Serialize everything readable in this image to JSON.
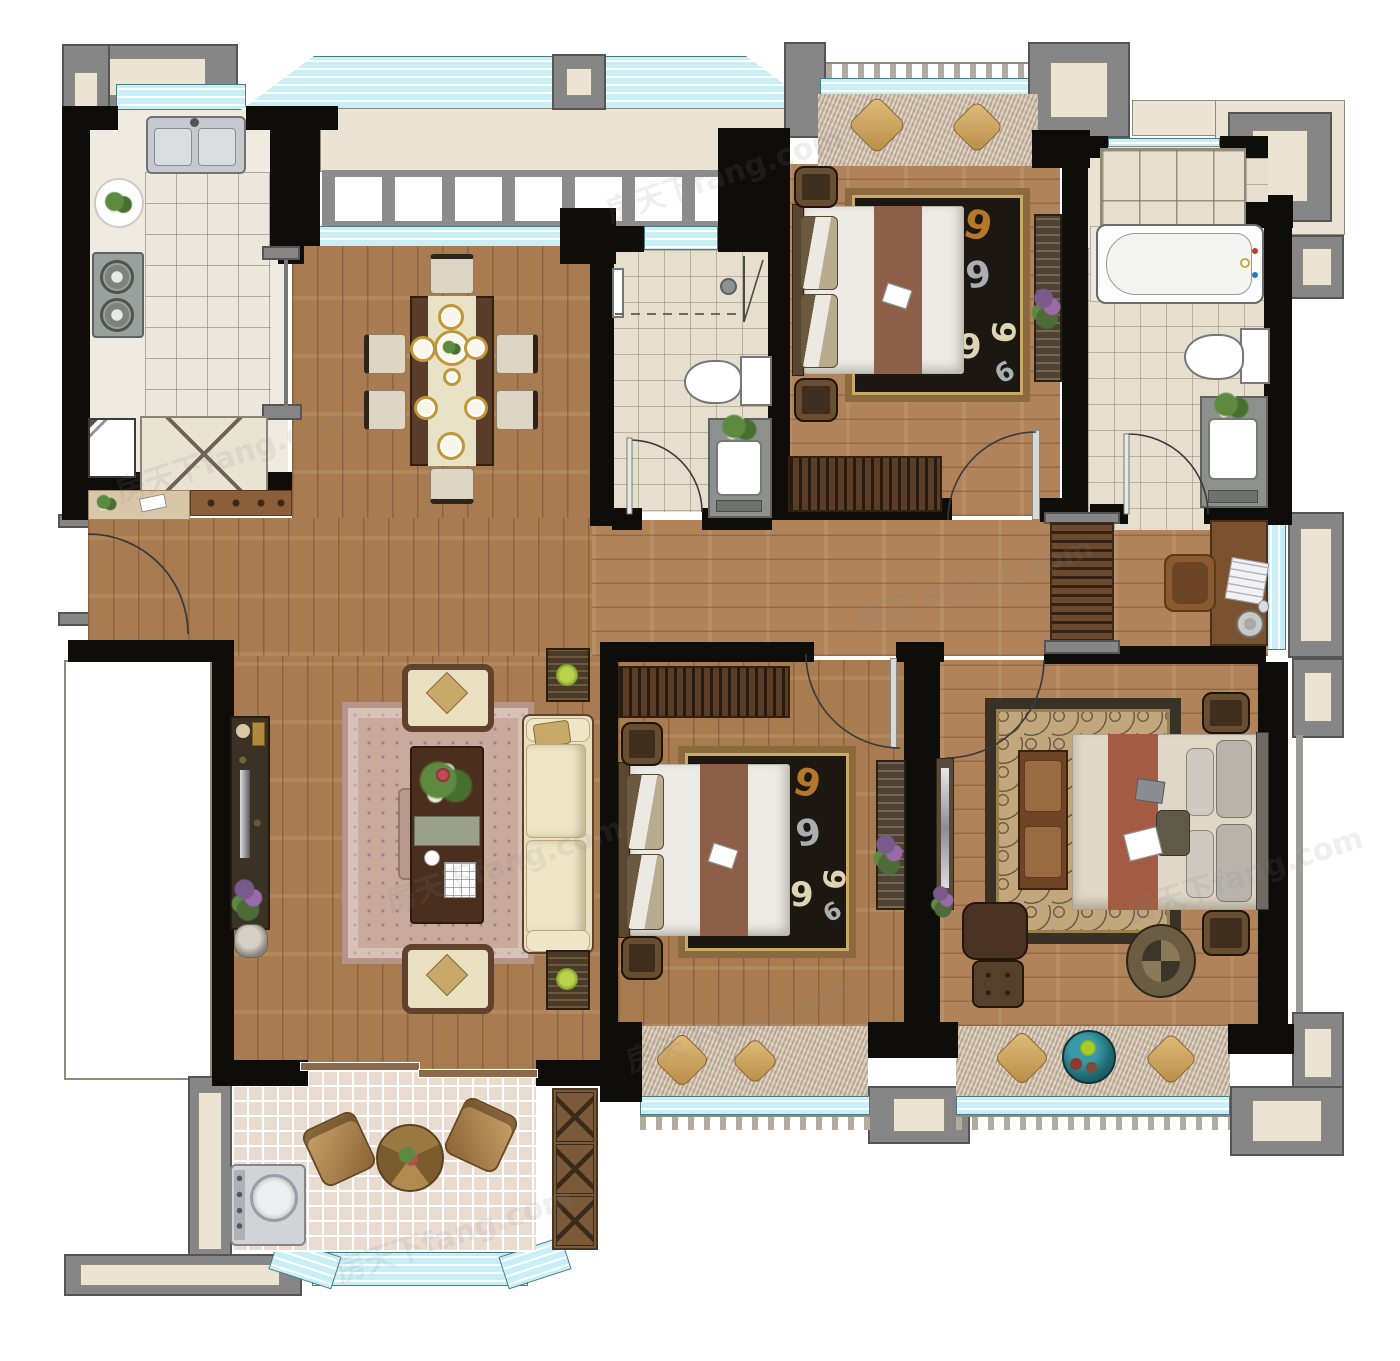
{
  "watermark": {
    "text": "房天下fang.com"
  },
  "colors": {
    "wall": "#0f0d0a",
    "wood": "#a87c50",
    "woodLight": "#b0835a",
    "glass": "#c7eff5",
    "glassEdge": "#4a7d86",
    "trimGray": "#868686",
    "trimDark": "#555555",
    "beige": "#ebe4d2",
    "beigeLine": "#8f8a79",
    "tileKitchen": "#ece7dd",
    "tileBath": "#e6dfcd",
    "tileBalcony": "#eadbd0",
    "shag": "#c9b7a1",
    "rugBlack": "#1d1712",
    "rugGold": "#b5782a",
    "rugSilver": "#a9aeb3",
    "rugCream": "#ddd3b5",
    "rugTrim": "#8a6a3e",
    "masterRug": "#c2a77d",
    "masterRugDark": "#3a3126",
    "livingRug": "#c9ab9d",
    "livingRugTrim": "#b5948a",
    "sofa": "#e9e0c2",
    "frame": "#5f412c",
    "bedWhite": "#edebe6",
    "runner": "#8d5f49",
    "masterRunner": "#a35c43",
    "steel": "#c6c9ce",
    "counter": "#f0ebe1"
  },
  "rooms": [
    {
      "name": "kitchen",
      "furniture": [
        "double-sink",
        "gas-stove",
        "prep-plate",
        "refrigerator",
        "base-cabinet",
        "pocket-door"
      ]
    },
    {
      "name": "dining-room",
      "furniture": [
        "dining-table",
        "table-runner",
        "six-chairs",
        "gold-rim-tableware"
      ]
    },
    {
      "name": "foyer",
      "furniture": [
        "entry-door",
        "shoe-console"
      ]
    },
    {
      "name": "interior-bathroom",
      "furniture": [
        "shower-area",
        "shower-glass",
        "toilet",
        "vanity-with-plant",
        "door"
      ]
    },
    {
      "name": "bedroom-top-right",
      "furniture": [
        "double-bed",
        "two-nightstands",
        "black-swirl-rug",
        "slatted-wardrobe",
        "tall-cabinet",
        "door"
      ]
    },
    {
      "name": "walk-in-closet",
      "furniture": [
        "wardrobe-cabinets"
      ]
    },
    {
      "name": "master-bathroom",
      "furniture": [
        "bathtub",
        "toilet",
        "vanity-with-plant",
        "door"
      ]
    },
    {
      "name": "hallway-study",
      "furniture": [
        "slatted-cabinet",
        "desk",
        "desk-chair",
        "laptop",
        "mug"
      ]
    },
    {
      "name": "living-room",
      "furniture": [
        "three-seat-sofa",
        "two-armchairs",
        "coffee-table",
        "tv-console",
        "two-side-tables",
        "purple-plant",
        "ornate-rug",
        "sliding-door"
      ]
    },
    {
      "name": "bedroom-bottom-middle",
      "furniture": [
        "double-bed",
        "two-nightstands",
        "black-swirl-rug",
        "slatted-wardrobe",
        "tall-cabinet",
        "door"
      ]
    },
    {
      "name": "master-bedroom",
      "furniture": [
        "double-bed",
        "foot-bench",
        "two-nightstands",
        "scroll-rug",
        "recliner",
        "pouf",
        "mirror-dresser",
        "door"
      ]
    },
    {
      "name": "laundry-balcony",
      "furniture": [
        "washing-machine",
        "round-marble-table",
        "two-wicker-chairs",
        "x-front-cabinet",
        "bay-window"
      ]
    },
    {
      "name": "balcony-top-right",
      "furniture": [
        "shag-rug",
        "two-pillows"
      ]
    },
    {
      "name": "balcony-bottom-middle",
      "furniture": [
        "shag-rug",
        "two-pillows"
      ]
    },
    {
      "name": "balcony-bottom-right",
      "furniture": [
        "shag-rug",
        "two-pillows",
        "fruit-bowl"
      ]
    }
  ]
}
